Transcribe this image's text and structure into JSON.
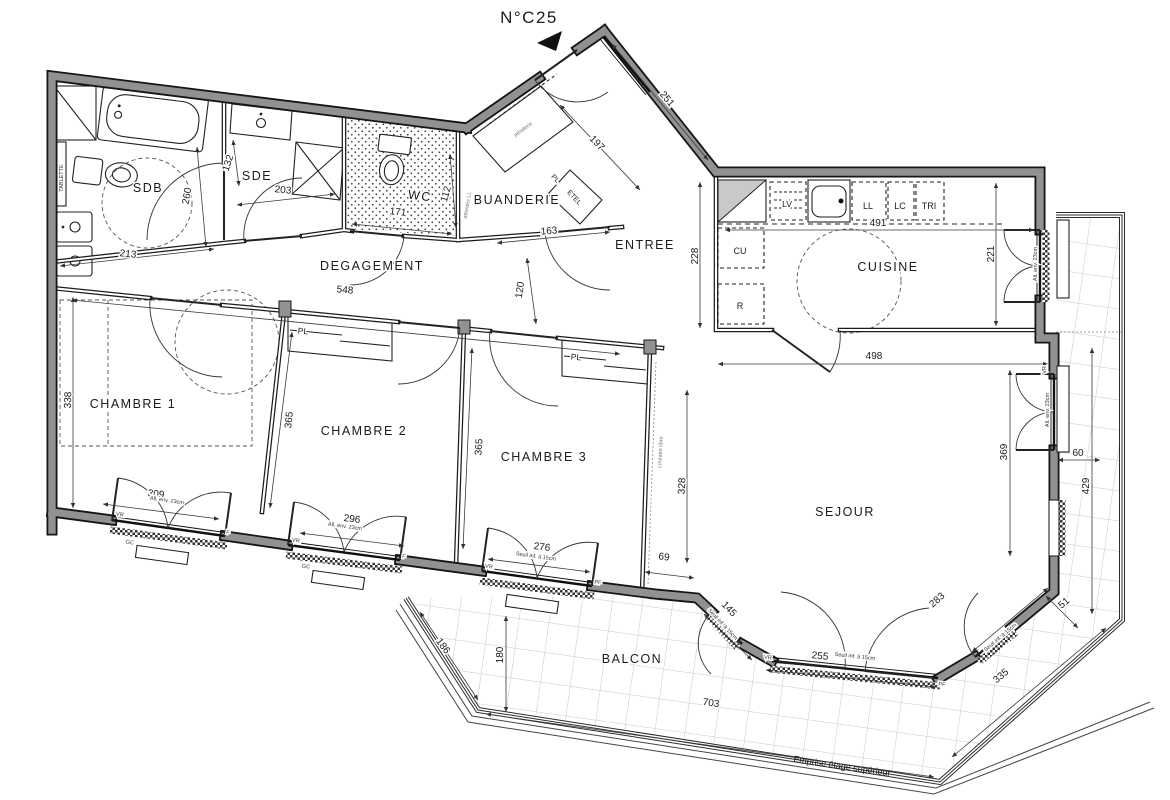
{
  "title": "N°C25",
  "rooms": {
    "sdb": "SDB",
    "sde": "SDE",
    "wc": "WC",
    "buanderie": "BUANDERIE",
    "degagement": "DEGAGEMENT",
    "entree": "ENTREE",
    "cuisine": "CUISINE",
    "chambre1": "CHAMBRE 1",
    "chambre2": "CHAMBRE 2",
    "chambre3": "CHAMBRE 3",
    "sejour": "SEJOUR",
    "balcon": "BALCON"
  },
  "dims": {
    "132": "132",
    "203": "203",
    "260": "260",
    "213": "213",
    "548": "548",
    "163": "163",
    "197": "197",
    "251": "251",
    "228": "228",
    "491": "491",
    "221": "221",
    "498": "498",
    "120": "120",
    "338": "338",
    "309": "309",
    "365a": "365",
    "365b": "365",
    "296": "296",
    "276": "276",
    "328": "328",
    "69": "69",
    "369": "369",
    "60": "60",
    "429": "429",
    "145": "145",
    "255": "255",
    "283": "283",
    "335": "335",
    "51": "51",
    "186": "186",
    "180": "180",
    "703": "703",
    "171": "171",
    "112": "112"
  },
  "annotations": {
    "tablette": "TABLETTE",
    "penderie": "penderie",
    "attentes_ll": "attentes LL",
    "etel": "ETEL",
    "pl": "PL",
    "lineaire_libre": "Linéaire libre",
    "emprise": "Emprise étage supérieur",
    "all_23": "All. env. 23cm",
    "seuil_15": "Seuil inf. à 15cm",
    "vr": "VR",
    "gc": "GC",
    "f": "F",
    "pf": "PF"
  },
  "kitchen": {
    "lv": "LV",
    "ll": "LL",
    "lc": "LC",
    "tri": "TRI",
    "cu": "CU",
    "r": "R"
  },
  "colors": {
    "wall": "#919191",
    "line": "#151515",
    "tile_grid": "#c7c7c7"
  }
}
